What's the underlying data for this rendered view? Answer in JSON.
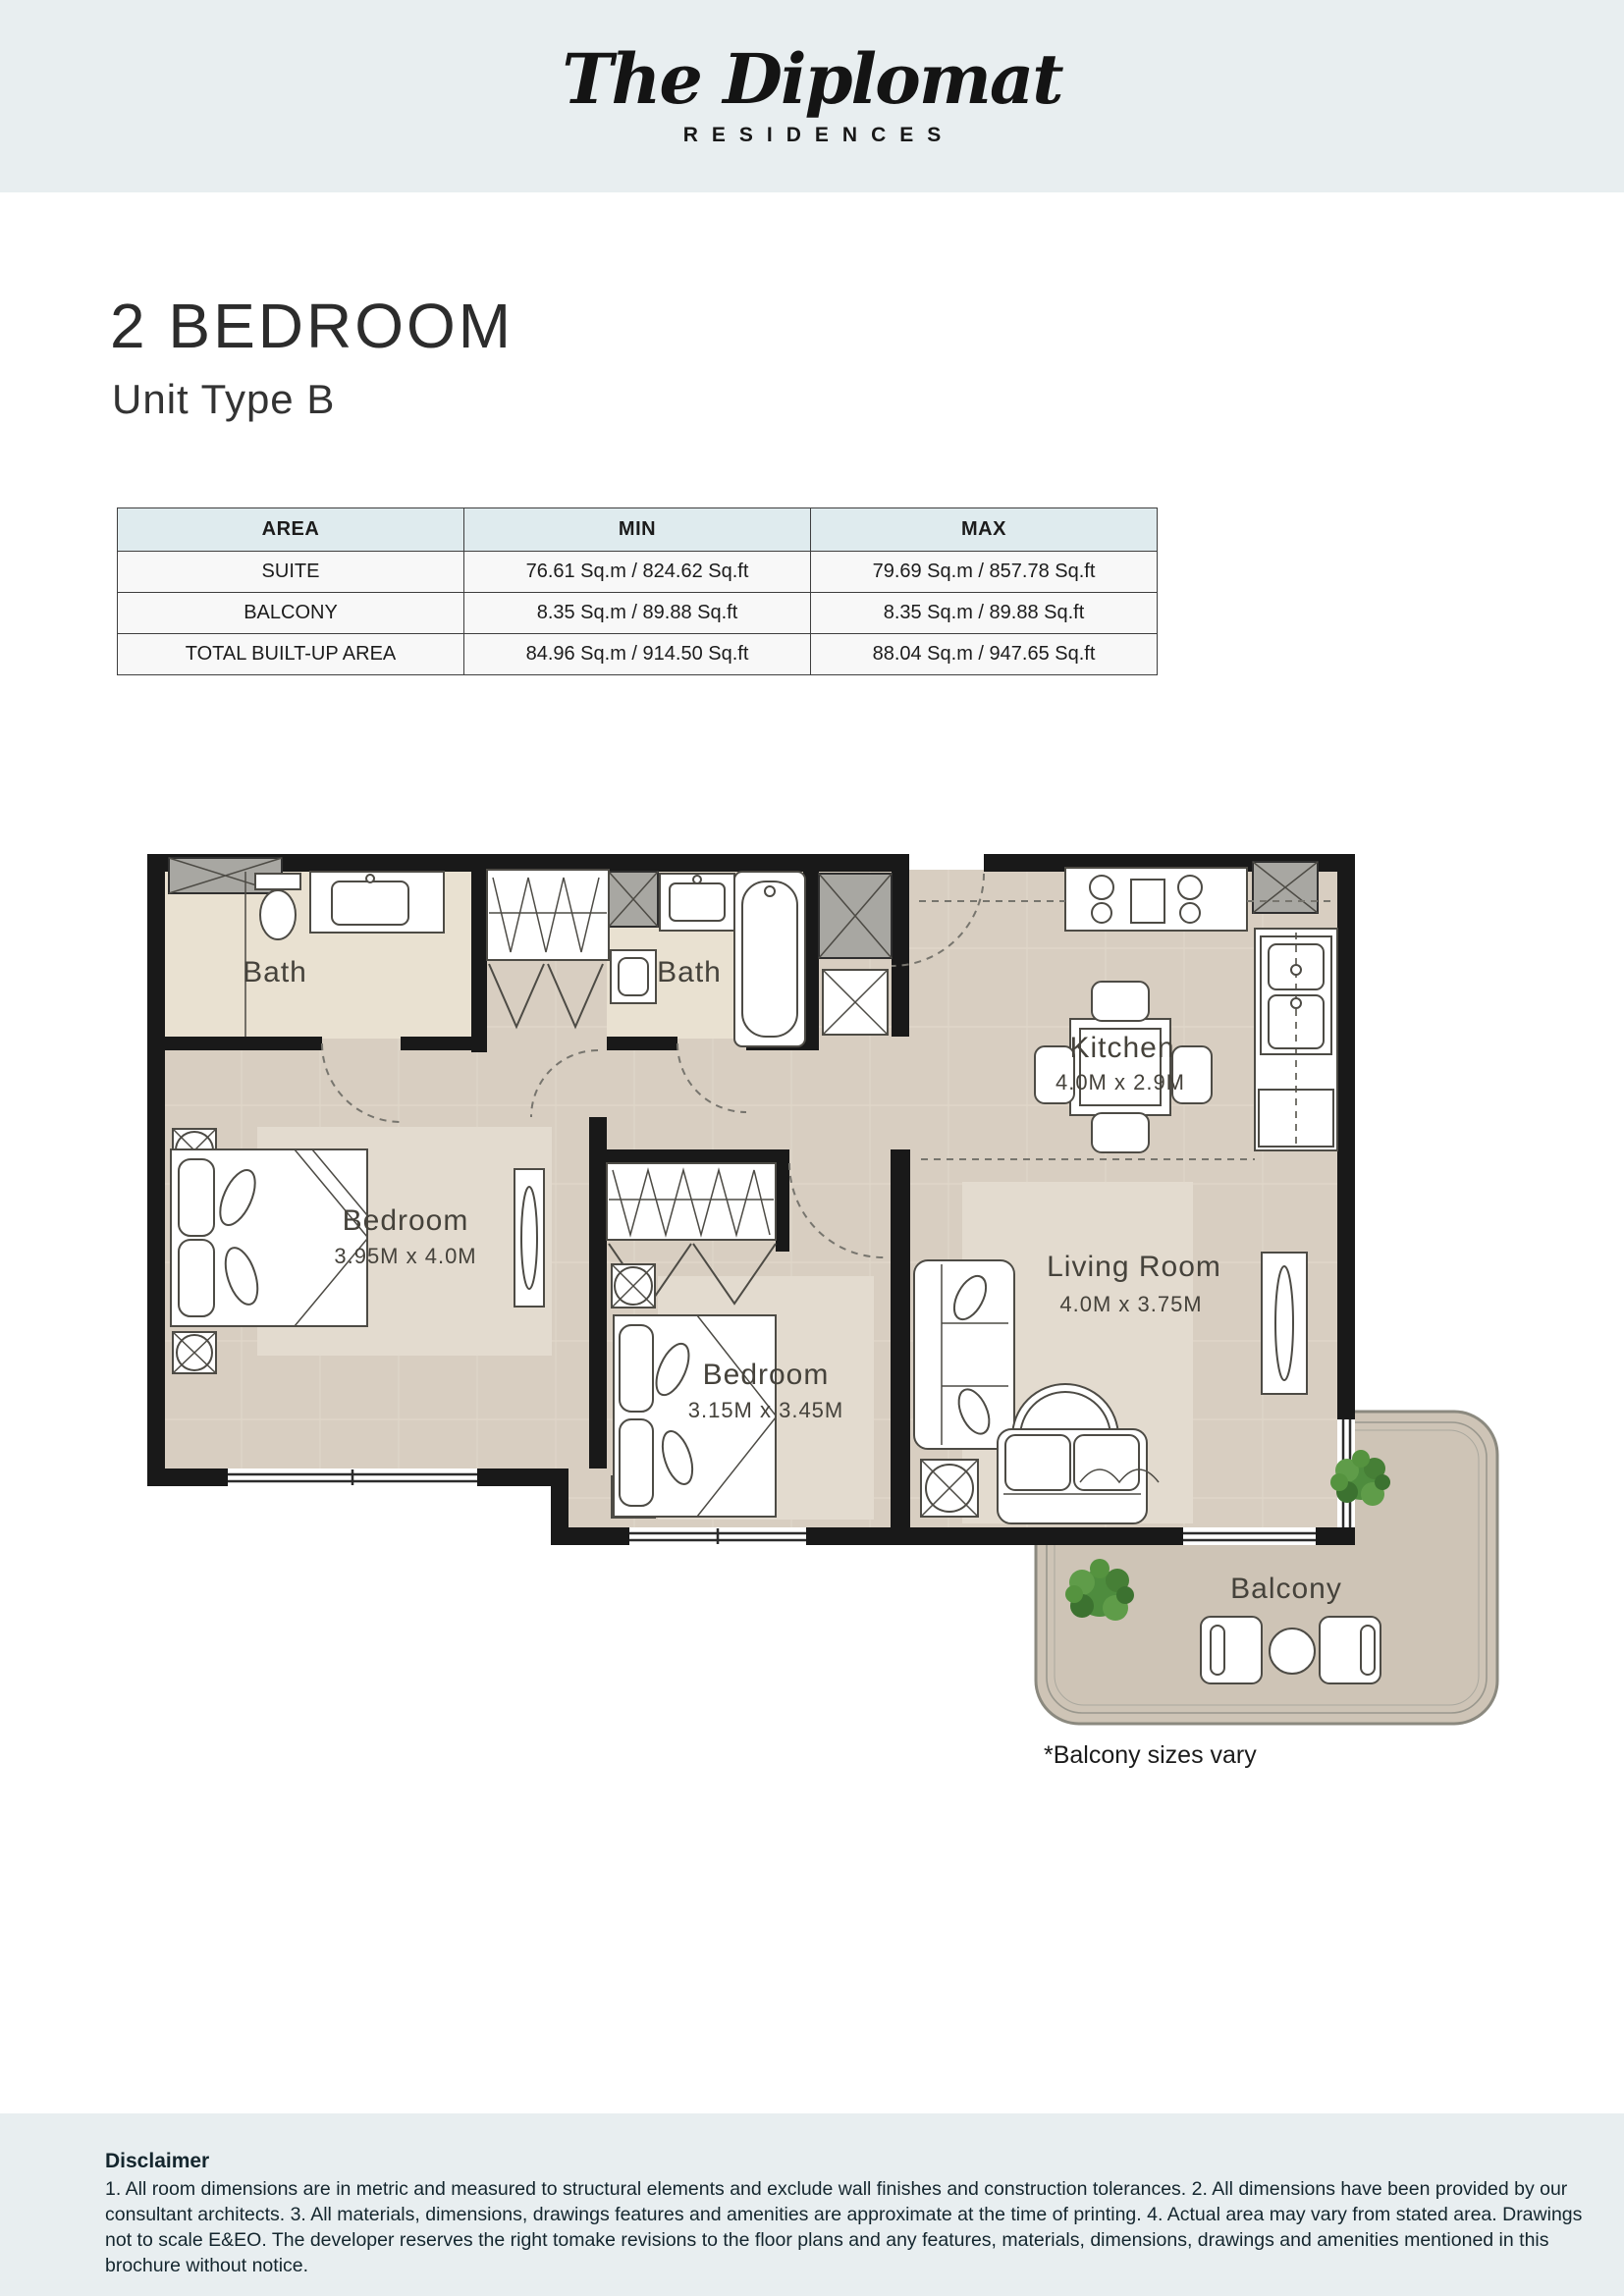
{
  "logo": {
    "name": "The Diplomat",
    "subtitle": "RESIDENCES"
  },
  "page": {
    "title": "2 BEDROOM",
    "subtitle": "Unit Type B"
  },
  "area_table": {
    "headers": [
      "AREA",
      "MIN",
      "MAX"
    ],
    "rows": [
      {
        "area": "SUITE",
        "min": "76.61 Sq.m / 824.62 Sq.ft",
        "max": "79.69 Sq.m / 857.78 Sq.ft"
      },
      {
        "area": "BALCONY",
        "min": "8.35 Sq.m / 89.88 Sq.ft",
        "max": "8.35 Sq.m / 89.88 Sq.ft"
      },
      {
        "area": "TOTAL BUILT-UP AREA",
        "min": "84.96 Sq.m / 914.50 Sq.ft",
        "max": "88.04 Sq.m / 947.65 Sq.ft"
      }
    ]
  },
  "floor_plan": {
    "rooms": {
      "bath1": {
        "label": "Bath"
      },
      "bath2": {
        "label": "Bath"
      },
      "kitchen": {
        "label": "Kitchen",
        "dims": "4.0M x 2.9M"
      },
      "bedroom1": {
        "label": "Bedroom",
        "dims": "3.95M x 4.0M"
      },
      "bedroom2": {
        "label": "Bedroom",
        "dims": "3.15M x 3.45M"
      },
      "living": {
        "label": "Living Room",
        "dims": "4.0M x 3.75M"
      },
      "balcony": {
        "label": "Balcony"
      }
    },
    "note": "*Balcony sizes vary"
  },
  "disclaimer": {
    "title": "Disclaimer",
    "body": "1. All room dimensions are in metric and measured to structural elements and exclude wall finishes and construction tolerances. 2. All dimensions have been provided by our consultant architects. 3. All materials, dimensions, drawings features and amenities are approximate at the time of printing. 4. Actual area may vary from stated area. Drawings not to scale E&EO. The developer reserves the right tomake revisions to the floor plans and any features, materials, dimensions, drawings and amenities mentioned in this brochure without notice."
  },
  "colors": {
    "band": "#e8eef0",
    "table_header": "#dfebee",
    "wall": "#191919",
    "floor": "#d8cec1",
    "bath_floor": "#e9e1d1",
    "rug": "#e3dbcf",
    "balcony_floor": "#cec4b6",
    "plant_green": "#4e8c3e"
  }
}
